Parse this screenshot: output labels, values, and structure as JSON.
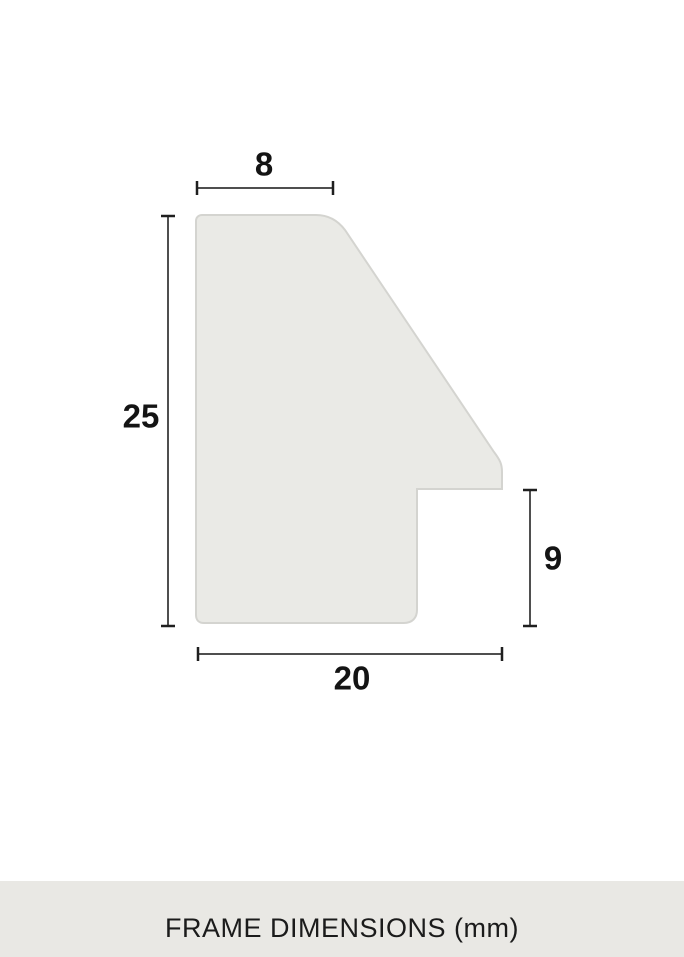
{
  "diagram": {
    "title": "FRAME DIMENSIONS (mm)",
    "units": "mm",
    "subject": "picture-frame-moulding-profile-cross-section",
    "measurements": {
      "top_width": {
        "label": "8",
        "value": 8
      },
      "overall_height": {
        "label": "25",
        "value": 25
      },
      "rabbet_height": {
        "label": "9",
        "value": 9
      },
      "bottom_width": {
        "label": "20",
        "value": 20
      }
    },
    "colors": {
      "background": "#ffffff",
      "profile_fill": "#eaeae6",
      "profile_stroke": "#d4d4d0",
      "dimension_line": "#4f4f4f",
      "dimension_tick": "#1f1f1f",
      "label_text": "#141414",
      "caption_bar_bg": "#e9e8e4",
      "caption_text": "#1b1b1b"
    }
  }
}
